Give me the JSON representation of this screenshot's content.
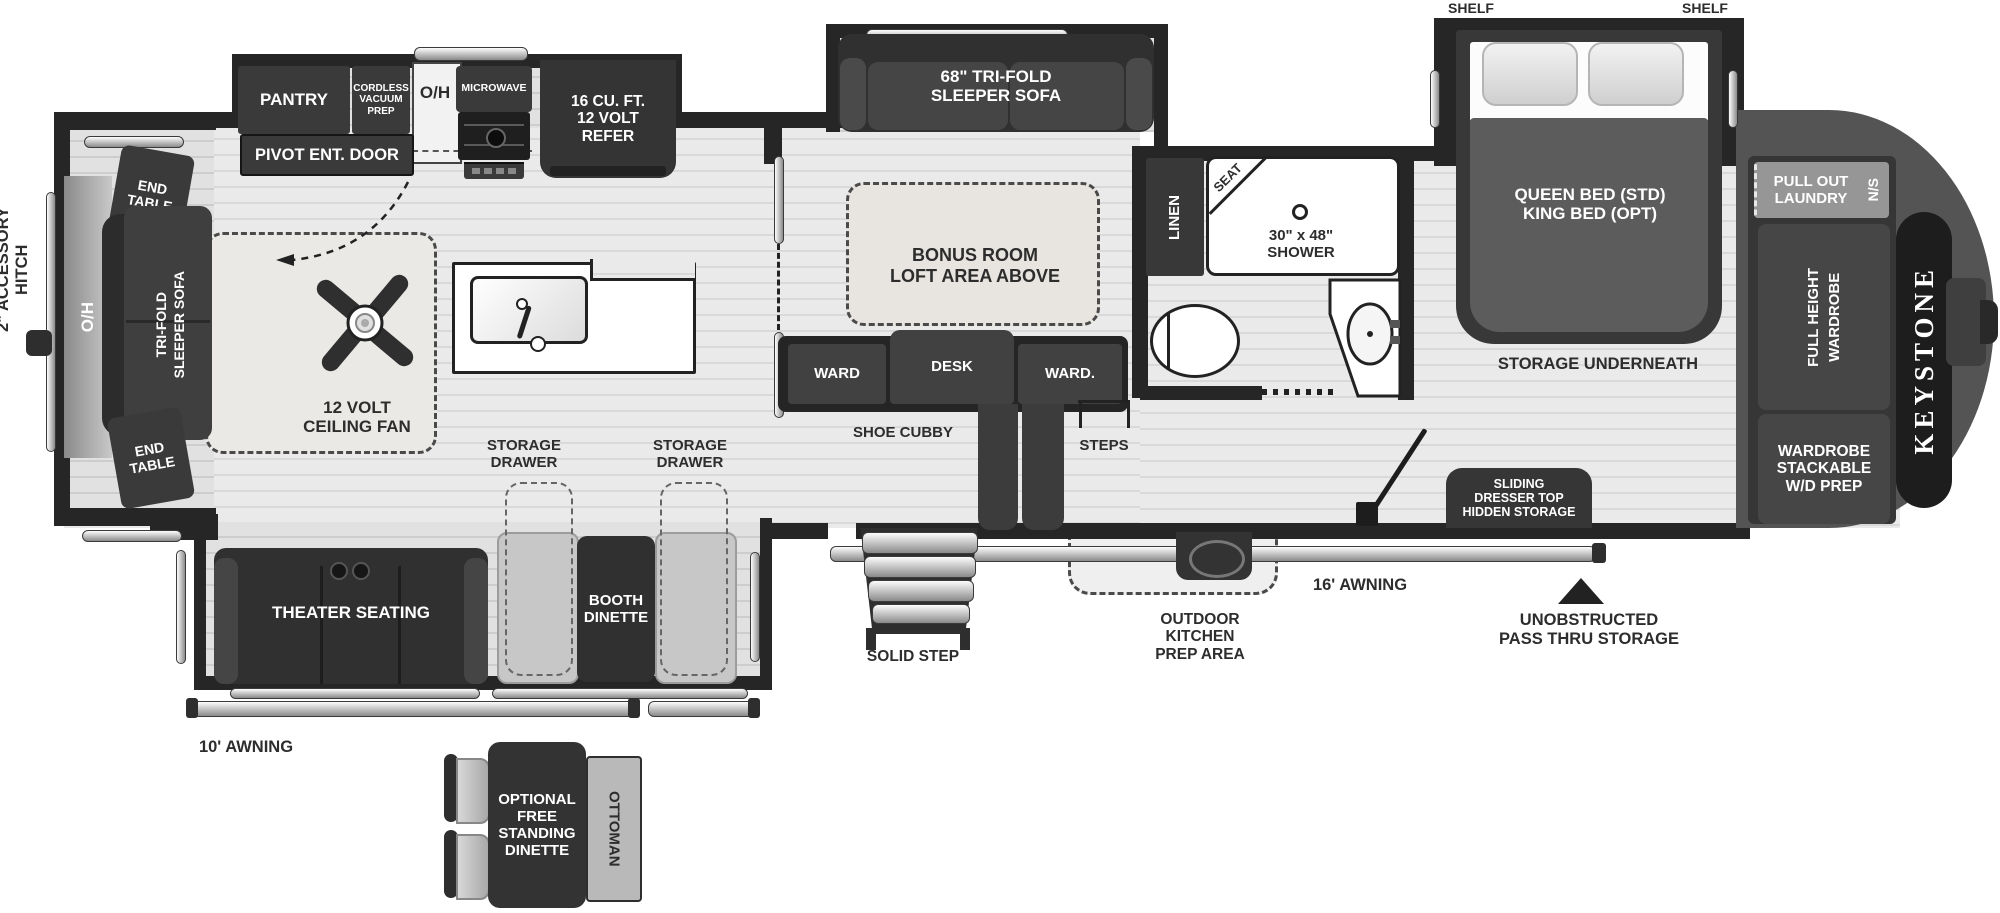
{
  "brand": "KEYSTONE",
  "hitch": {
    "accessory": "2\" ACCESSORY HITCH"
  },
  "rear_living": {
    "end_table_top": "END\nTABLE",
    "end_table_bottom": "END\nTABLE",
    "overhead": "O/H",
    "trifold_sofa": "TRI-FOLD\nSLEEPER SOFA",
    "ceiling_fan": "12 VOLT\nCEILING FAN",
    "theater_seating": "THEATER SEATING"
  },
  "kitchen": {
    "pantry": "PANTRY",
    "cordless_vacuum": "CORDLESS\nVACUUM\nPREP",
    "overhead": "O/H",
    "microwave": "MICROWAVE",
    "refer": "16 CU. FT.\n12 VOLT\nREFER",
    "pivot_door": "PIVOT ENT. DOOR",
    "storage_drawer_left": "STORAGE\nDRAWER",
    "storage_drawer_right": "STORAGE\nDRAWER",
    "booth_dinette": "BOOTH\nDINETTE"
  },
  "bonus_room": {
    "sofa": "68\" TRI-FOLD\nSLEEPER SOFA",
    "loft": "BONUS ROOM\nLOFT AREA ABOVE",
    "ward_left": "WARD",
    "desk": "DESK",
    "ward_right": "WARD.",
    "shoe_cubby": "SHOE CUBBY",
    "steps": "STEPS"
  },
  "bathroom": {
    "linen": "LINEN",
    "seat": "SEAT",
    "shower": "30\" x 48\"\nSHOWER"
  },
  "bedroom": {
    "shelf_left": "SHELF",
    "shelf_right": "SHELF",
    "bed": "QUEEN BED (STD)\nKING BED (OPT)",
    "storage_underneath": "STORAGE UNDERNEATH",
    "dresser": "SLIDING\nDRESSER TOP\nHIDDEN STORAGE",
    "laundry": "PULL OUT\nLAUNDRY",
    "laundry_ns": "N/S",
    "wardrobe_full": "FULL HEIGHT\nWARDROBE",
    "wardrobe_wd": "WARDROBE\nSTACKABLE\nW/D PREP"
  },
  "exterior": {
    "awning_10": "10' AWNING",
    "awning_16": "16' AWNING",
    "solid_step": "SOLID STEP",
    "outdoor_kitchen": "OUTDOOR\nKITCHEN\nPREP AREA",
    "pass_thru": "UNOBSTRUCTED\nPASS THRU STORAGE"
  },
  "optional_dinette": {
    "table": "OPTIONAL\nFREE\nSTANDING\nDINETTE",
    "ottoman": "OTTOMAN"
  },
  "colors": {
    "wall": "#262626",
    "furniture": "#3a3a3a",
    "floor": "#e8e8e8"
  }
}
